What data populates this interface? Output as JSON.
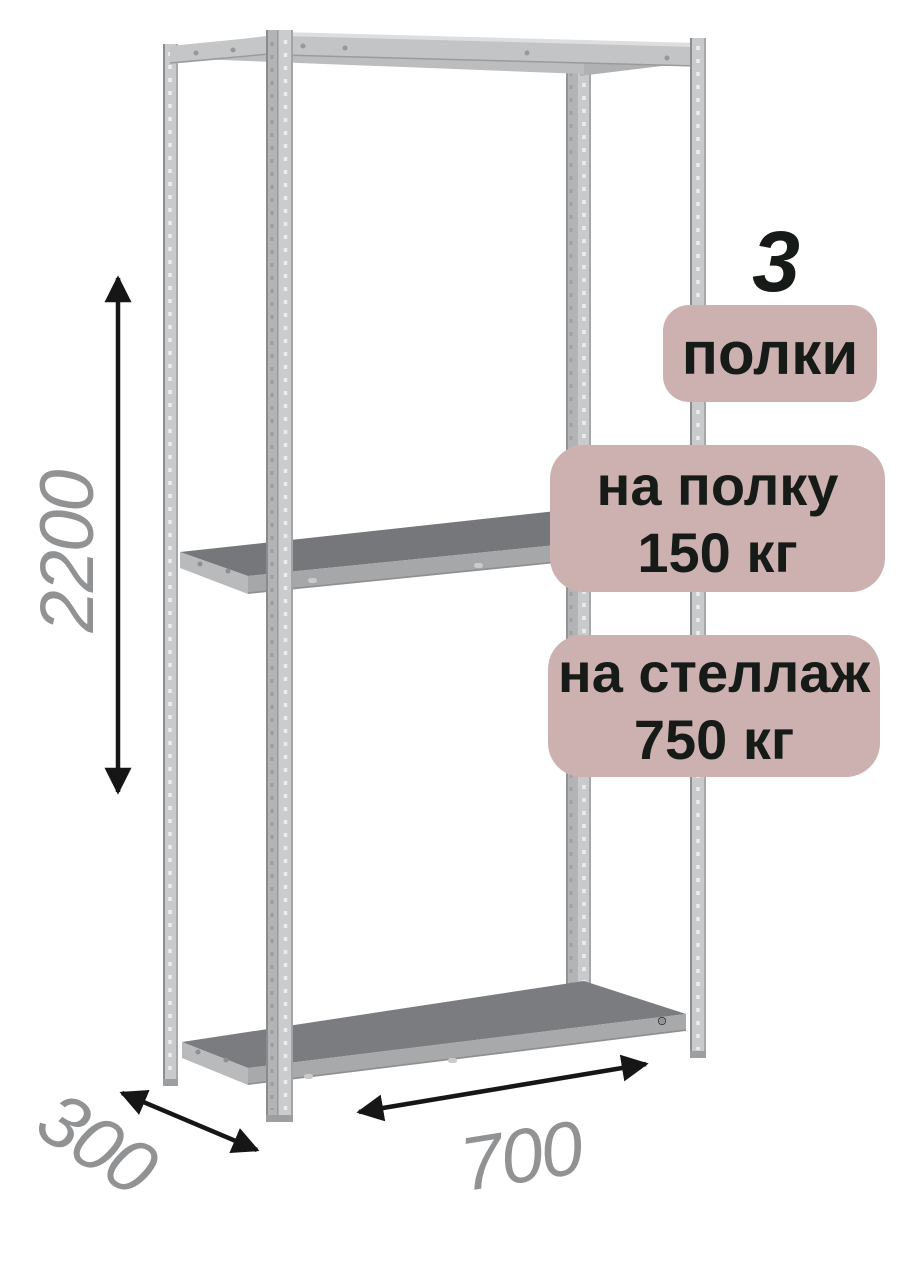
{
  "diagram": {
    "subject": "metal-shelving-rack",
    "dimensions": {
      "height": "2200",
      "depth": "300",
      "width": "700"
    },
    "shelf_count": 3
  },
  "badges": {
    "shelf_count": {
      "number": "3",
      "label": "полки"
    },
    "per_shelf_load": {
      "line1": "на полку",
      "line2": "150 кг"
    },
    "per_rack_load": {
      "line1": "на стеллаж",
      "line2": "750 кг"
    }
  },
  "icons": {
    "height_arrow": "double-headed-vertical-arrow",
    "depth_arrow": "double-headed-diagonal-arrow",
    "width_arrow": "double-headed-diagonal-arrow"
  },
  "colors": {
    "background": "#ffffff",
    "badge_bg": "#ccb1b0",
    "badge_text": "#171b17",
    "dim_text": "#919294",
    "arrow": "#161616",
    "metal_light": "#c9cacc",
    "metal_flange": "#b3b4b6",
    "metal_edge": "#8c8d8f",
    "metal_mid": "#a8a9ab",
    "shelf_top": "#76777a",
    "shelf_side": "#b9babc",
    "beam_top": "#dddee0"
  }
}
